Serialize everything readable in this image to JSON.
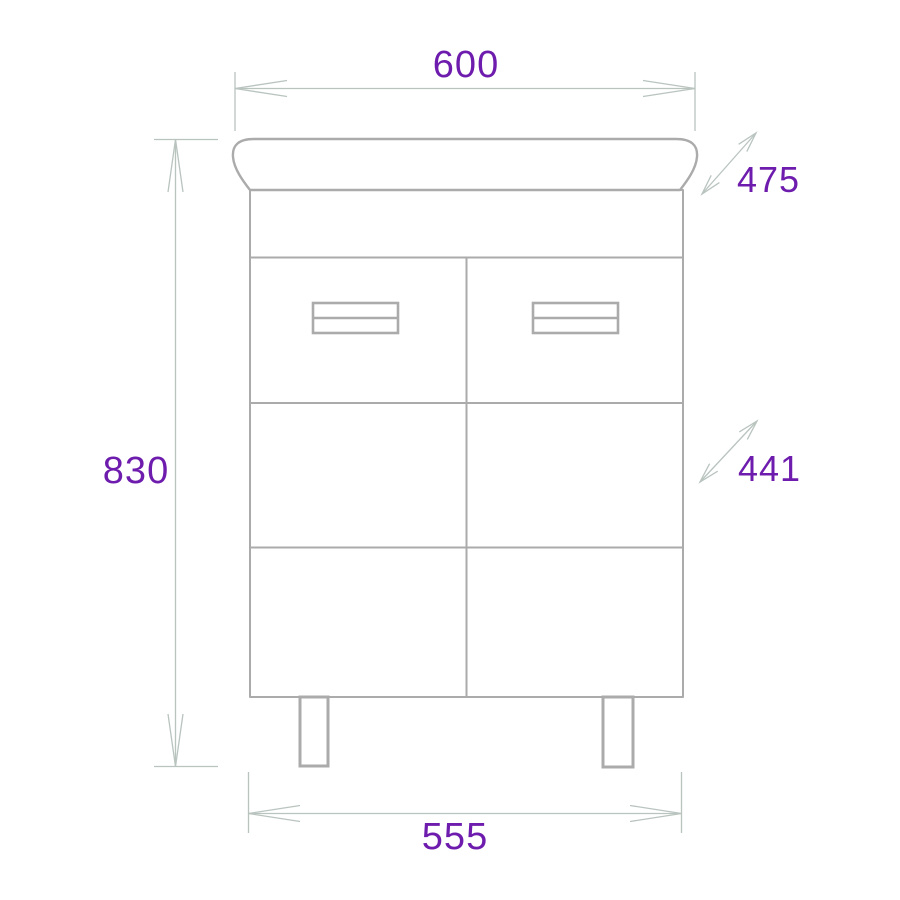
{
  "drawing": {
    "kind": "furniture dimension drawing",
    "subject": "bathroom vanity washbasin cabinet, front view",
    "labels": {
      "top_width": "600",
      "basin_depth": "475",
      "overall_height": "830",
      "cabinet_depth": "441",
      "cabinet_width": "555"
    },
    "colors": {
      "outline": "#ababab",
      "dimension_line": "#b9c4bf",
      "label_text": "#6e1cad",
      "background": "#ffffff"
    }
  }
}
